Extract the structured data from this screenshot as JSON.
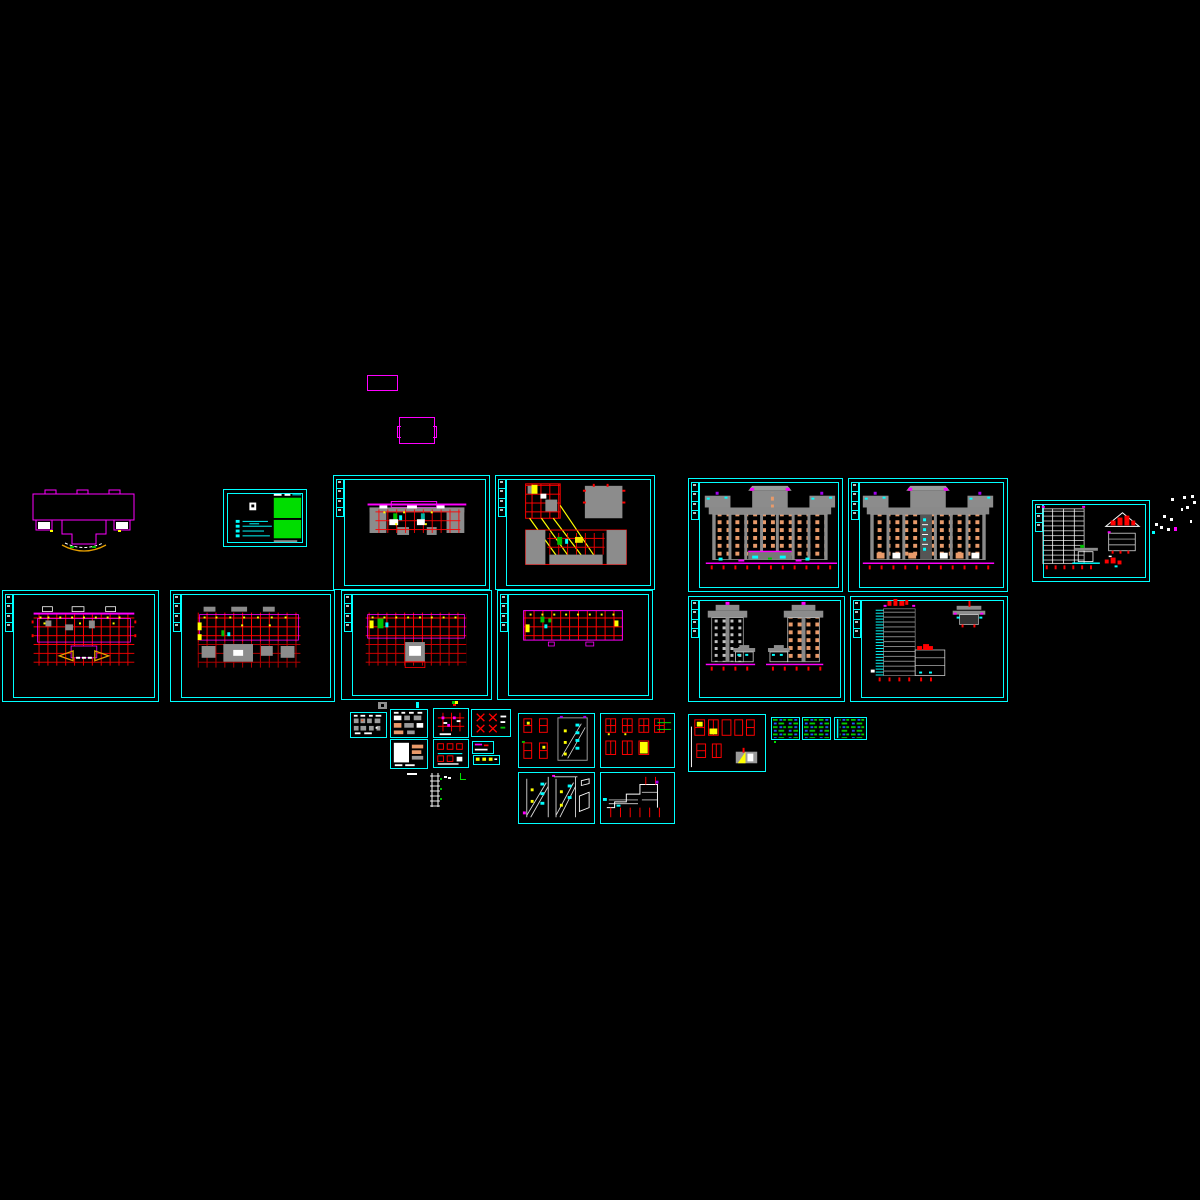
{
  "app": {
    "name": "cad-model-space",
    "background": "#000000",
    "visible_text": ""
  },
  "palette": {
    "frame": "#00ffff",
    "magenta": "#ff00ff",
    "red": "#ff0000",
    "yellow": "#ffff00",
    "green": "#00e000",
    "blue": "#2060ff",
    "gray": "#8c8c8c",
    "white": "#ffffff",
    "salmon": "#e89a6a",
    "purple": "#a000f0",
    "bg": "#000000"
  },
  "sheets": {
    "pa": {
      "name": "plan-sheet-a",
      "kind": "floor-plan"
    },
    "rp": {
      "name": "roof-framing-plan-sheet",
      "kind": "roof-plan"
    },
    "fe1": {
      "name": "front-elevation-sheet",
      "kind": "elevation"
    },
    "fe2": {
      "name": "rear-elevation-sheet",
      "kind": "elevation"
    },
    "sec": {
      "name": "building-section-sheet",
      "kind": "section"
    },
    "p2": {
      "name": "first-floor-plan-sheet",
      "kind": "floor-plan"
    },
    "p3": {
      "name": "second-floor-plan-sheet",
      "kind": "floor-plan"
    },
    "p4": {
      "name": "typical-floor-plan-sheet",
      "kind": "floor-plan"
    },
    "p5": {
      "name": "upper-floor-plan-sheet",
      "kind": "floor-plan"
    },
    "se": {
      "name": "side-elevations-sheet",
      "kind": "elevation"
    },
    "sx": {
      "name": "section-and-pavilion-sheet",
      "kind": "section"
    },
    "t1": {
      "name": "cover-title-sheet",
      "kind": "title-block"
    },
    "d1": {
      "name": "toilet-details-sheet",
      "kind": "detail"
    },
    "d2": {
      "name": "wall-details-sheet",
      "kind": "detail"
    },
    "d3": {
      "name": "finish-details-sheet",
      "kind": "detail"
    },
    "d4": {
      "name": "grid-detail-sheet",
      "kind": "detail"
    },
    "d5": {
      "name": "truss-node-details-sheet",
      "kind": "detail"
    },
    "d6": {
      "name": "railing-details-sheet",
      "kind": "detail"
    },
    "d7": {
      "name": "small-detail-a",
      "kind": "detail"
    },
    "d8": {
      "name": "small-detail-b",
      "kind": "detail"
    },
    "s1": {
      "name": "column-and-stair-details-sheet",
      "kind": "detail"
    },
    "s2": {
      "name": "window-details-sheet",
      "kind": "detail"
    },
    "s3": {
      "name": "stair-sections-sheet",
      "kind": "detail"
    },
    "s4": {
      "name": "annex-section-sheet",
      "kind": "detail"
    },
    "s5": {
      "name": "window-schedule-details-sheet",
      "kind": "detail"
    },
    "n1": {
      "name": "notes-sheet-a",
      "kind": "notes"
    },
    "n2": {
      "name": "notes-sheet-b",
      "kind": "notes"
    },
    "n3": {
      "name": "notes-sheet-c",
      "kind": "notes"
    }
  },
  "loose_items": {
    "lr1": {
      "name": "small-magenta-rectangle"
    },
    "lr2": {
      "name": "notched-magenta-rectangle"
    },
    "fo": {
      "name": "building-footprint-outline"
    },
    "ladder": {
      "name": "stair-ladder-detail"
    },
    "scatter": {
      "name": "stray-text-marks"
    }
  }
}
